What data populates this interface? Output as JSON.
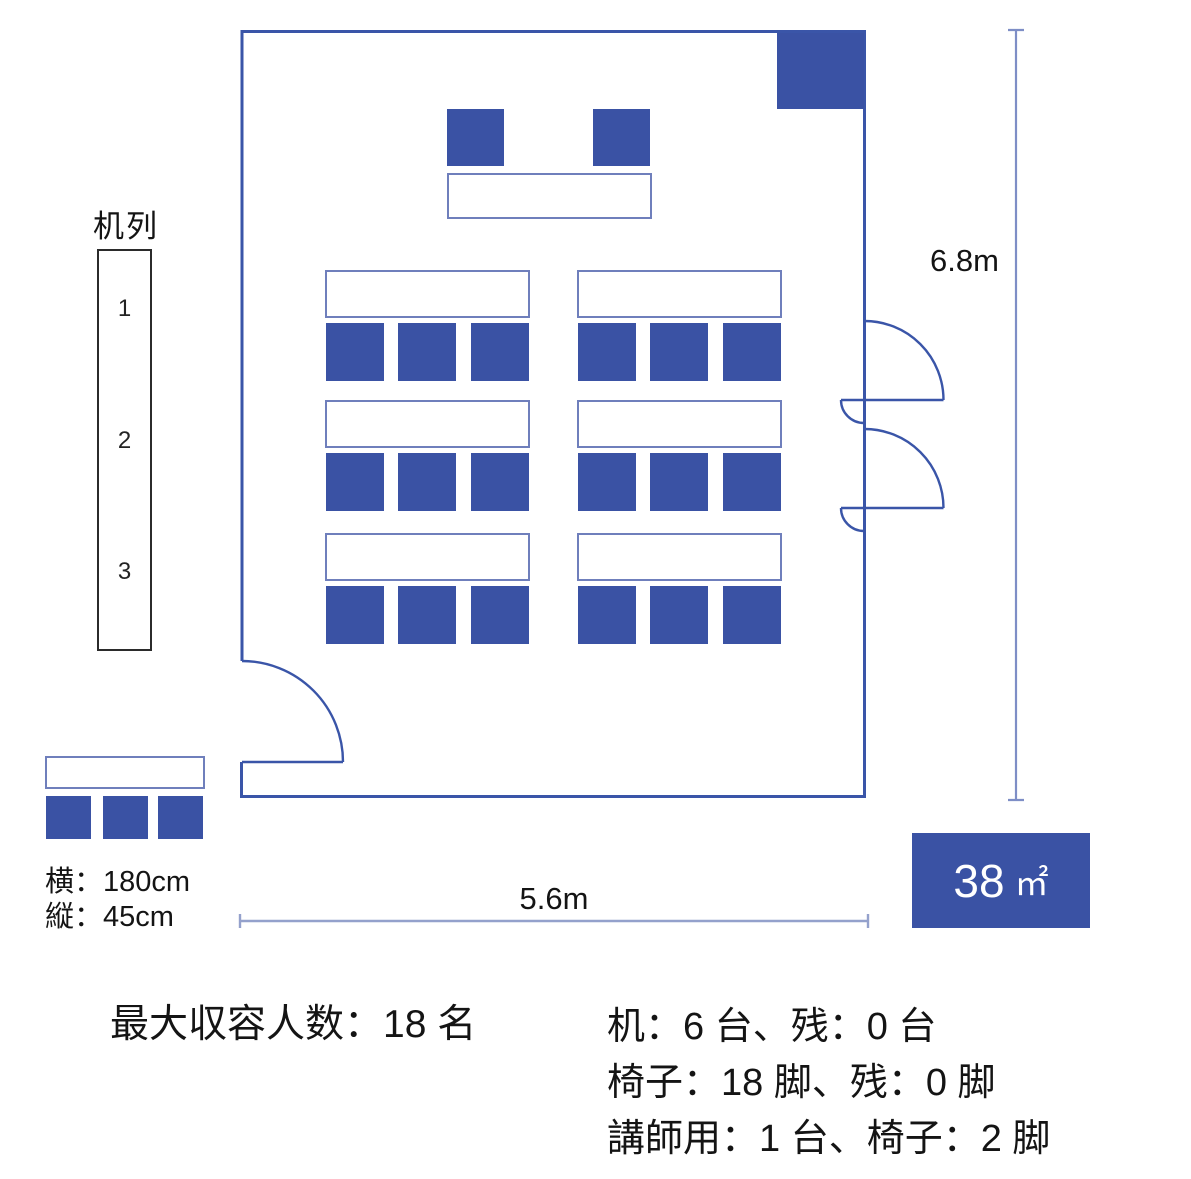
{
  "colors": {
    "primary_blue": "#3a52a4",
    "wall_blue": "#3a55a8",
    "desk_border": "#6f7fbc",
    "dim_line_vertical": "#7e8ec6",
    "dim_line_horizontal": "#94a1cc"
  },
  "legend": {
    "title": "机列",
    "rows": [
      "1",
      "2",
      "3"
    ]
  },
  "room": {
    "height_label": "6.8m",
    "width_label": "5.6m",
    "area_value": "38",
    "area_unit": "㎡"
  },
  "sample_desk": {
    "width_label": "横：180cm",
    "depth_label": "縦：45cm"
  },
  "floorplan": {
    "desk_rows": 3,
    "desk_cols": 2,
    "chairs_per_desk": 3,
    "lecturer_desks": 1,
    "lecturer_chairs": 2
  },
  "summary": {
    "capacity": "最大収容人数：18 名",
    "desks": "机：6 台、残：0 台",
    "chairs": "椅子：18 脚、残：0 脚",
    "lecturer": "講師用：1 台、椅子：2 脚"
  }
}
